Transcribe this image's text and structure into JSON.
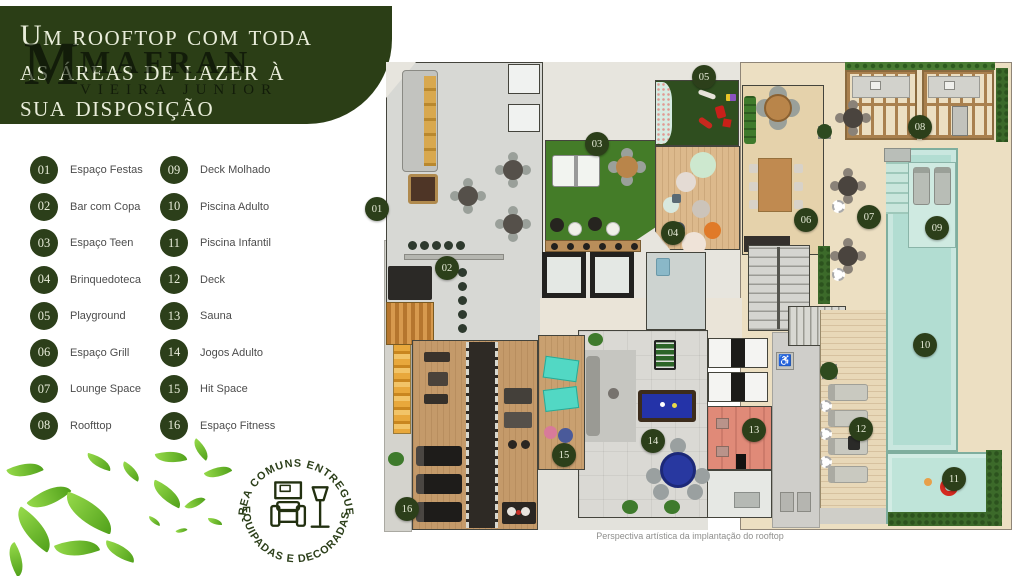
{
  "banner": {
    "title_lines": [
      "Um rooftop com toda",
      "as áreas de lazer à",
      "sua disposição"
    ],
    "bg_color": "#2b3e16",
    "text_color": "#e9edda"
  },
  "watermark": {
    "name": "MAFRAN",
    "subtitle": "VIEIRA JUNIOR"
  },
  "legend": {
    "items": [
      {
        "num": "01",
        "label": "Espaço Festas"
      },
      {
        "num": "02",
        "label": "Bar com Copa"
      },
      {
        "num": "03",
        "label": "Espaço Teen"
      },
      {
        "num": "04",
        "label": "Brinquedoteca"
      },
      {
        "num": "05",
        "label": "Playground"
      },
      {
        "num": "06",
        "label": "Espaço Grill"
      },
      {
        "num": "07",
        "label": "Lounge Space"
      },
      {
        "num": "08",
        "label": "Roofttop"
      },
      {
        "num": "09",
        "label": "Deck Molhado"
      },
      {
        "num": "10",
        "label": "Piscina Adulto"
      },
      {
        "num": "11",
        "label": "Piscina Infantil"
      },
      {
        "num": "12",
        "label": "Deck"
      },
      {
        "num": "13",
        "label": "Sauna"
      },
      {
        "num": "14",
        "label": "Jogos Adulto"
      },
      {
        "num": "15",
        "label": "Hit Space"
      },
      {
        "num": "16",
        "label": "Espaço Fitness"
      }
    ]
  },
  "stamp": {
    "text_top": "ÁREA COMUNS ENTREGUES",
    "text_bottom": "EQUIPADAS E DECORADAS*",
    "color": "#2c3f1a",
    "icons": [
      "picture-frame-icon",
      "armchair-icon",
      "floor-lamp-icon"
    ]
  },
  "plan": {
    "caption": "Perspectiva artística da implantação do rooftop",
    "marker_color": "#2c3f1a",
    "colors": {
      "pool": "#b2ddd2",
      "wet_deck": "#cfeae1",
      "teen_grass": "#447c28",
      "playground_grass": "#2f4e1f",
      "wood_deck": "#ecdfc2",
      "gym_wood": "#c49a6a",
      "sauna": "#e08a78",
      "party_floor": "#d7d8d4"
    },
    "markers": [
      {
        "num": "01",
        "label": "Espaço Festas",
        "x": 377,
        "y": 209
      },
      {
        "num": "02",
        "label": "Bar com Copa",
        "x": 447,
        "y": 268
      },
      {
        "num": "03",
        "label": "Espaço Teen",
        "x": 597,
        "y": 144
      },
      {
        "num": "04",
        "label": "Brinquedoteca",
        "x": 673,
        "y": 233
      },
      {
        "num": "05",
        "label": "Playground",
        "x": 704,
        "y": 77
      },
      {
        "num": "06",
        "label": "Espaço Grill",
        "x": 806,
        "y": 220
      },
      {
        "num": "07",
        "label": "Lounge Space",
        "x": 869,
        "y": 217
      },
      {
        "num": "08",
        "label": "Roofttop",
        "x": 920,
        "y": 127
      },
      {
        "num": "09",
        "label": "Deck Molhado",
        "x": 937,
        "y": 228
      },
      {
        "num": "10",
        "label": "Piscina Adulto",
        "x": 925,
        "y": 345
      },
      {
        "num": "11",
        "label": "Piscina Infantil",
        "x": 954,
        "y": 479
      },
      {
        "num": "12",
        "label": "Deck",
        "x": 861,
        "y": 429
      },
      {
        "num": "13",
        "label": "Sauna",
        "x": 754,
        "y": 430
      },
      {
        "num": "14",
        "label": "Jogos Adulto",
        "x": 653,
        "y": 441
      },
      {
        "num": "15",
        "label": "Hit Space",
        "x": 564,
        "y": 455
      },
      {
        "num": "16",
        "label": "Espaço Fitness",
        "x": 407,
        "y": 509
      }
    ]
  }
}
